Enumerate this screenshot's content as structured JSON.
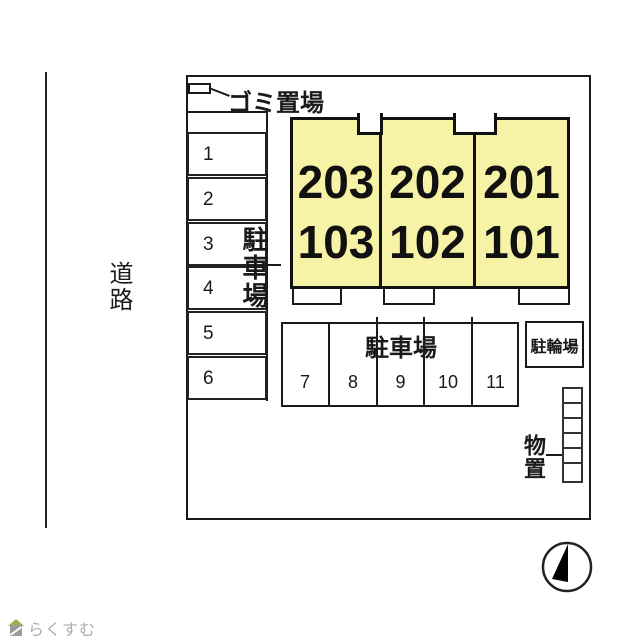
{
  "plan": {
    "road_label": "道路",
    "garbage": {
      "label": "ゴミ置場"
    },
    "left_parking": {
      "label": "駐車場",
      "spaces": [
        "1",
        "2",
        "3",
        "4",
        "5",
        "6"
      ]
    },
    "building": {
      "units": [
        {
          "upper": "203",
          "lower": "103"
        },
        {
          "upper": "202",
          "lower": "102"
        },
        {
          "upper": "201",
          "lower": "101"
        }
      ]
    },
    "lower_parking": {
      "label": "駐車場",
      "spaces": [
        "7",
        "8",
        "9",
        "10",
        "11"
      ]
    },
    "bicycle": {
      "label": "駐輪場"
    },
    "storage": {
      "label": "物置"
    }
  },
  "footer": {
    "logo_text": "らくすむ"
  },
  "colors": {
    "building_fill": "#f7f3a6",
    "line": "#1a1a1a",
    "logo_text": "#b5adab",
    "logo_roof": "#a9a84b",
    "logo_body": "#9b9b9b"
  }
}
